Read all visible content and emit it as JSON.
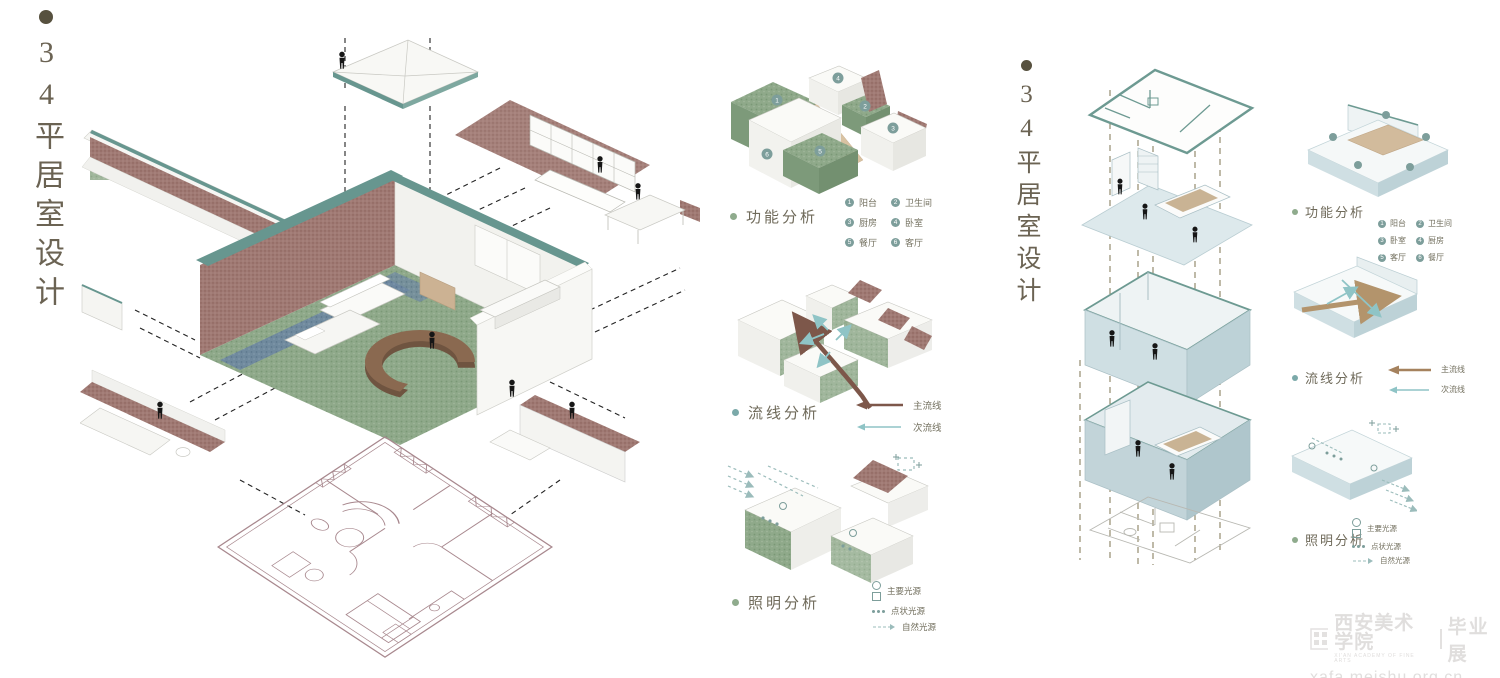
{
  "left_panel": {
    "title": "34平居室设计"
  },
  "right_panel_title": {
    "title": "34平居室设计"
  },
  "middle_panel": {
    "sections": [
      {
        "label": "功能分析"
      },
      {
        "label": "流线分析"
      },
      {
        "label": "照明分析"
      }
    ],
    "function_legend": [
      {
        "num": "1",
        "label": "阳台"
      },
      {
        "num": "2",
        "label": "卫生间"
      },
      {
        "num": "3",
        "label": "厨房"
      },
      {
        "num": "4",
        "label": "卧室"
      },
      {
        "num": "5",
        "label": "餐厅"
      },
      {
        "num": "6",
        "label": "客厅"
      }
    ],
    "circulation_legend": [
      {
        "label": "主流线"
      },
      {
        "label": "次流线"
      }
    ],
    "lighting_legend": [
      {
        "label": "主要光源"
      },
      {
        "label": "点状光源"
      },
      {
        "label": "自然光源"
      }
    ]
  },
  "right_panel": {
    "sections": [
      {
        "label": "功能分析"
      },
      {
        "label": "流线分析"
      },
      {
        "label": "照明分析"
      }
    ],
    "function_legend": [
      {
        "num": "1",
        "label": "阳台"
      },
      {
        "num": "2",
        "label": "卫生间"
      },
      {
        "num": "3",
        "label": "卧室"
      },
      {
        "num": "4",
        "label": "厨房"
      },
      {
        "num": "5",
        "label": "客厅"
      },
      {
        "num": "6",
        "label": "餐厅"
      }
    ],
    "circulation_legend": [
      {
        "label": "主流线"
      },
      {
        "label": "次流线"
      }
    ],
    "lighting_legend": [
      {
        "label": "主要光源"
      },
      {
        "label": "点状光源"
      },
      {
        "label": "自然光源"
      }
    ]
  },
  "watermark": {
    "school": "西安美术学院",
    "school_en": "XI'AN ACADEMY OF FINE ARTS",
    "exhibition": "毕业展",
    "url": "xafa.meishu.org.cn"
  },
  "colors": {
    "accent_teal": "#67968f",
    "brick": "#9a6f69",
    "green_block": "#8fab8d",
    "main_flow_arrow": "#7d574a",
    "secondary_flow_arrow": "#8fc4c6",
    "title_text": "#6b6353",
    "plan_line": "#a8888e"
  }
}
